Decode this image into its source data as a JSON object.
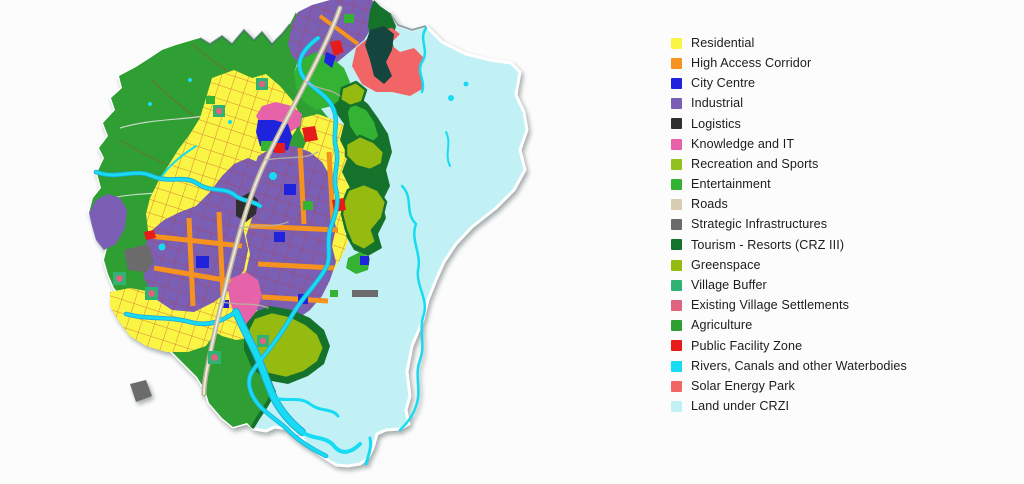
{
  "palette": {
    "residential": "#FAF545",
    "high_access_corridor": "#F6921E",
    "city_centre": "#2023DC",
    "industrial": "#7A5FB5",
    "logistics": "#2E2E2E",
    "knowledge_it": "#E763A9",
    "recreation_sports": "#92C01F",
    "entertainment": "#33B233",
    "roads": "#D8CDB2",
    "strategic": "#6B6B6B",
    "tourism": "#15722B",
    "greenspace": "#95BB10",
    "village_buffer": "#2FB273",
    "village_settlements": "#E06480",
    "agriculture": "#2F9E33",
    "public_facility": "#E81B1B",
    "water": "#16DBF2",
    "water_deep": "#1FA8D8",
    "solar": "#F16566",
    "crz": "#C2F1F5",
    "road_casing": "#B9B29C",
    "road_center": "#EDE8DA",
    "grid_red": "#C0392B",
    "field_line": "#A84632",
    "field_road": "#EAEAEA",
    "coast_shadow": "#35585A",
    "teal_dark": "#14453F",
    "map_outline": "#FFFFFF"
  },
  "legend": {
    "items": [
      {
        "label": "Residential",
        "key": "residential"
      },
      {
        "label": "High Access Corridor",
        "key": "high_access_corridor"
      },
      {
        "label": "City Centre",
        "key": "city_centre"
      },
      {
        "label": "Industrial",
        "key": "industrial"
      },
      {
        "label": "Logistics",
        "key": "logistics"
      },
      {
        "label": "Knowledge and IT",
        "key": "knowledge_it"
      },
      {
        "label": "Recreation and Sports",
        "key": "recreation_sports"
      },
      {
        "label": "Entertainment",
        "key": "entertainment"
      },
      {
        "label": "Roads",
        "key": "roads"
      },
      {
        "label": "Strategic Infrastructures",
        "key": "strategic"
      },
      {
        "label": "Tourism - Resorts (CRZ III)",
        "key": "tourism"
      },
      {
        "label": "Greenspace",
        "key": "greenspace"
      },
      {
        "label": "Village Buffer",
        "key": "village_buffer"
      },
      {
        "label": "Existing Village Settlements",
        "key": "village_settlements"
      },
      {
        "label": "Agriculture",
        "key": "agriculture"
      },
      {
        "label": "Public Facility Zone",
        "key": "public_facility"
      },
      {
        "label": "Rivers, Canals and other Waterbodies",
        "key": "water"
      },
      {
        "label": "Solar Energy Park",
        "key": "solar"
      },
      {
        "label": "Land under CRZI",
        "key": "crz"
      }
    ]
  }
}
